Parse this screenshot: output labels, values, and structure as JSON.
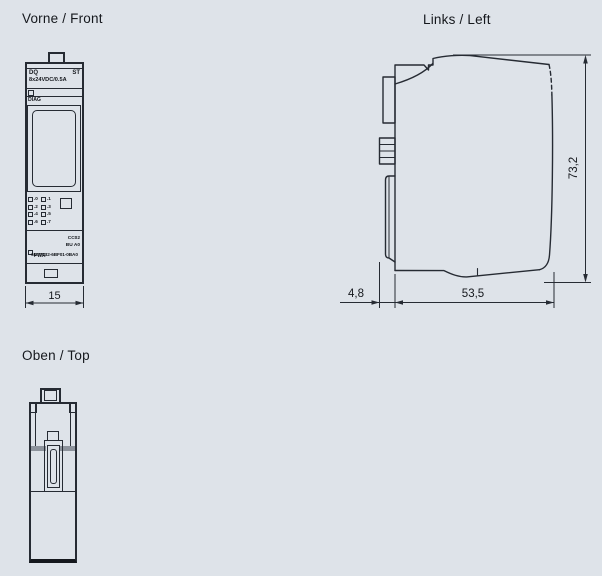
{
  "drawing": {
    "background_color": "#dee3e9",
    "line_color": "#262b33",
    "text_color": "#15181d"
  },
  "views": {
    "front": {
      "title": "Vorne / Front",
      "dim_width": "15"
    },
    "left": {
      "title": "Links / Left",
      "dim_height": "73,2",
      "dim_body_depth": "53,5",
      "dim_connector_depth": "4,8"
    },
    "top": {
      "title": "Oben / Top"
    }
  },
  "module": {
    "type": "DQ",
    "variant": "ST",
    "rating": "8x24VDC/0.5A",
    "diag_label": "DIAG",
    "channel_labels": [
      ".0",
      ".1",
      ".2",
      ".3",
      ".4",
      ".5",
      ".6",
      ".7"
    ],
    "pwr_label": "PWR",
    "color_code": "CC02",
    "base_unit": "BU A0",
    "article_number": "6ES7132-6BF01-0BA0"
  }
}
